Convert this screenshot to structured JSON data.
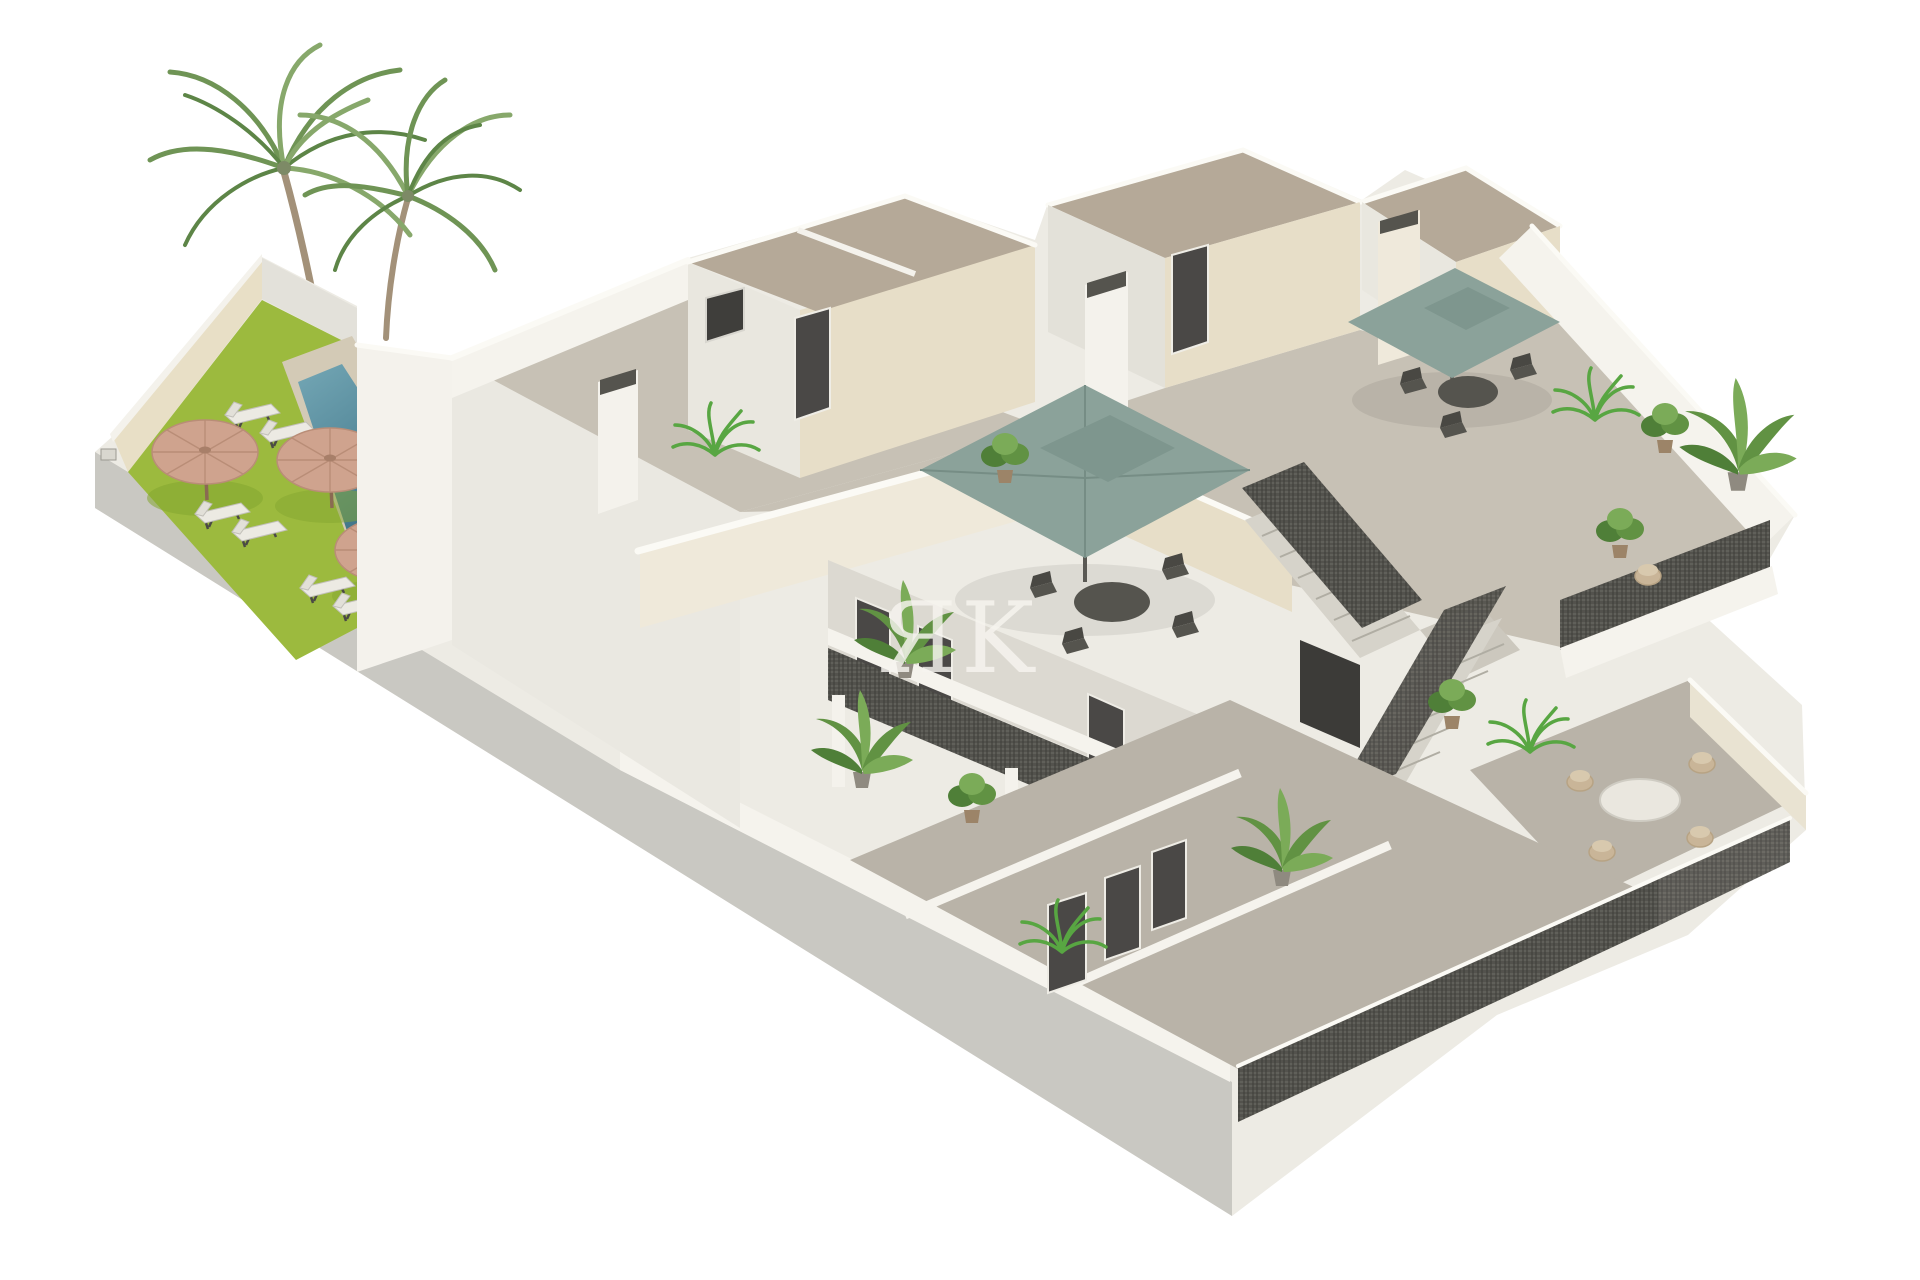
{
  "image": {
    "kind": "3D architectural render",
    "subject": "Isometric cutaway render of a modern two-storey apartment block with roof terraces, communal garden, swimming pool and an open central staircase",
    "background": "#ffffff"
  },
  "watermark": {
    "text": "ЯK",
    "color": "#f7f5f0",
    "opacity": "0.82"
  },
  "palette": {
    "background": "#ffffff",
    "wall-white": "#edebe4",
    "wall-bright": "#f4f2ec",
    "wall-cream": "#e7dec8",
    "wall-beige": "#e8dfc6",
    "facade-gray": "#c9c8c2",
    "roof-tan": "#b5a998",
    "floor-terrace": "#c7c1b5",
    "floor-patio": "#b9b3a8",
    "parapet-white": "#f5f3ed",
    "cap-white": "#fbfaf5",
    "grass": "#9cba3e",
    "grass-shadow": "#84a530",
    "pool-light": "#6fa3b2",
    "pool-dark": "#3c7185",
    "deck": "#d3cab6",
    "parasol-straw": "#cfa38e",
    "parasol-straw-rib": "#b98d77",
    "parasol-sage": "#8ba29a",
    "parasol-sage-dark": "#7e968e",
    "railing-dark": "#53524d",
    "door-dark": "#4a4846",
    "furniture-dark": "#55544e",
    "wicker": "#c9b598",
    "plant-green": "#619243",
    "plant-light": "#7bab58",
    "plant-deep": "#4f7f38",
    "trunk": "#a39179",
    "frond-1": "#6f9455",
    "frond-2": "#87a86b",
    "frond-3": "#5d8547",
    "watermark-color": "#f7f5f0"
  },
  "scene": {
    "garden": {
      "label": "communal garden with swimming pool",
      "features": [
        "two palm trees",
        "artificial lawn",
        "pool with stone surround",
        "3 straw parasols",
        "6 sun loungers",
        "side table"
      ]
    },
    "building": {
      "label": "two-storey apartment block",
      "features": [
        "white and cream rendered walls",
        "flat tan roofs with stair bulkheads",
        "chimneys",
        "roof terraces with 2 sage square parasols and dining sets",
        "open central staircase with dark mesh railings",
        "second-floor access walkway",
        "stacked balconies with plants",
        "ground-floor patios with dark mesh fences",
        "large blank gray side facade"
      ]
    }
  }
}
